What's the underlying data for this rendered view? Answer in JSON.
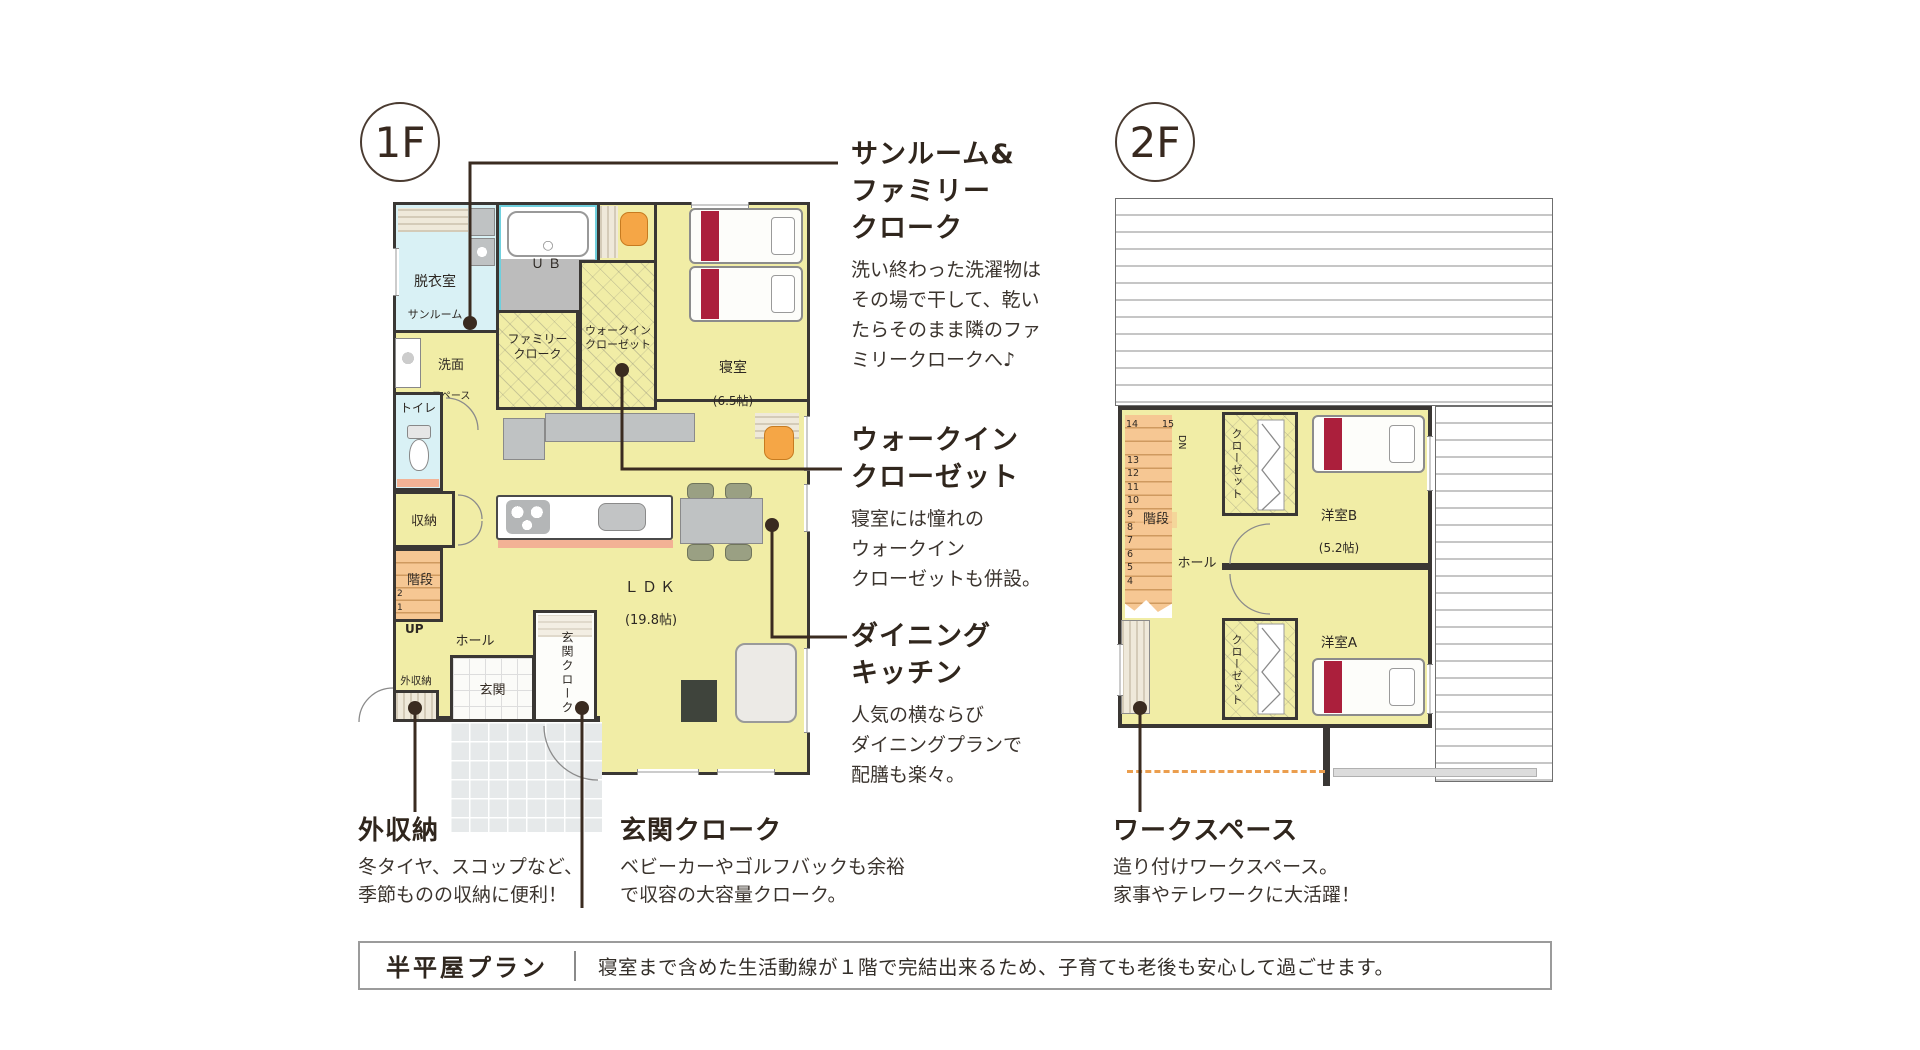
{
  "floor_labels": {
    "f1": "1F",
    "f2": "2F"
  },
  "floor1": {
    "rooms": {
      "datsuishitsu": "脱衣室",
      "sunroom": "サンルーム",
      "ub": "ＵＢ",
      "senmen": "洗面",
      "senmen_sub": "スペース",
      "family_cloak": "ファミリー\nクローク",
      "wic": "ウォークイン\nクローゼット",
      "bedroom": "寝室",
      "bedroom_size": "(6.5帖)",
      "toilet": "トイレ",
      "storage": "収納",
      "stairs": "階段",
      "stair_no2": "2",
      "stair_no1": "1",
      "up": "UP",
      "hall": "ホール",
      "entrance": "玄関",
      "entrance_cloak": "玄関クローク",
      "outdoor_storage": "外収納",
      "ldk": "ＬＤＫ",
      "ldk_size": "(19.8帖)"
    }
  },
  "floor2": {
    "rooms": {
      "stairs": "階段",
      "dn": "DN",
      "step14": "14",
      "step15": "15",
      "steps": [
        "13",
        "12",
        "11",
        "10",
        "9",
        "8",
        "7",
        "6",
        "5",
        "4"
      ],
      "hall": "ホール",
      "closet_b": "クローゼット",
      "closet_a": "クローゼット",
      "room_b": "洋室B",
      "room_b_size": "(5.2帖)",
      "room_a": "洋室A",
      "room_a_size": "(5.2帖)"
    }
  },
  "annotations": {
    "sunroom": {
      "title": "サンルーム&\nファミリー\nクローク",
      "body": "洗い終わった洗濯物は\nその場で干して、乾い\nたらそのまま隣のファ\nミリークロークへ♪"
    },
    "wic": {
      "title": "ウォークイン\nクローゼット",
      "body": "寝室には憧れの\nウォークイン\nクローゼットも併設。"
    },
    "dining": {
      "title": "ダイニング\nキッチン",
      "body": "人気の横ならび\nダイニングプランで\n配膳も楽々。"
    },
    "outdoor_storage": {
      "title": "外収納",
      "body": "冬タイヤ、スコップなど、\n季節ものの収納に便利！"
    },
    "entrance_cloak": {
      "title": "玄関クローク",
      "body": "ベビーカーやゴルフバックも余裕\nで収容の大容量クローク。"
    },
    "workspace": {
      "title": "ワークスペース",
      "body": "造り付けワークスペース。\n家事やテレワークに大活躍！"
    }
  },
  "banner": {
    "title": "半平屋プラン",
    "body": "寝室まで含めた生活動線が１階で完結出来るため、子育ても老後も安心して過ごせます。"
  },
  "colors": {
    "wall": "#3a3734",
    "room_yellow": "#f1eda6",
    "room_cyan": "#d9f1f5",
    "ub_cyan": "#6fd0de",
    "stairs_peach": "#f6c793",
    "bed_red": "#ab1f3c",
    "chair_orange": "#f5a646",
    "chair_olive": "#9aa083",
    "salmon": "#f3b295",
    "leader_brown": "#3a2b20",
    "title_text": "#30261d",
    "body_text": "#3b342e",
    "furniture_gray": "#bfc2c3",
    "porch_gray": "#e6e9ea",
    "roof_line_gray": "#c6c6c6",
    "hatch_beige": "#d4cbb8",
    "banner_border": "#9b9b9b",
    "dashed_orange": "#eb9e4e"
  }
}
